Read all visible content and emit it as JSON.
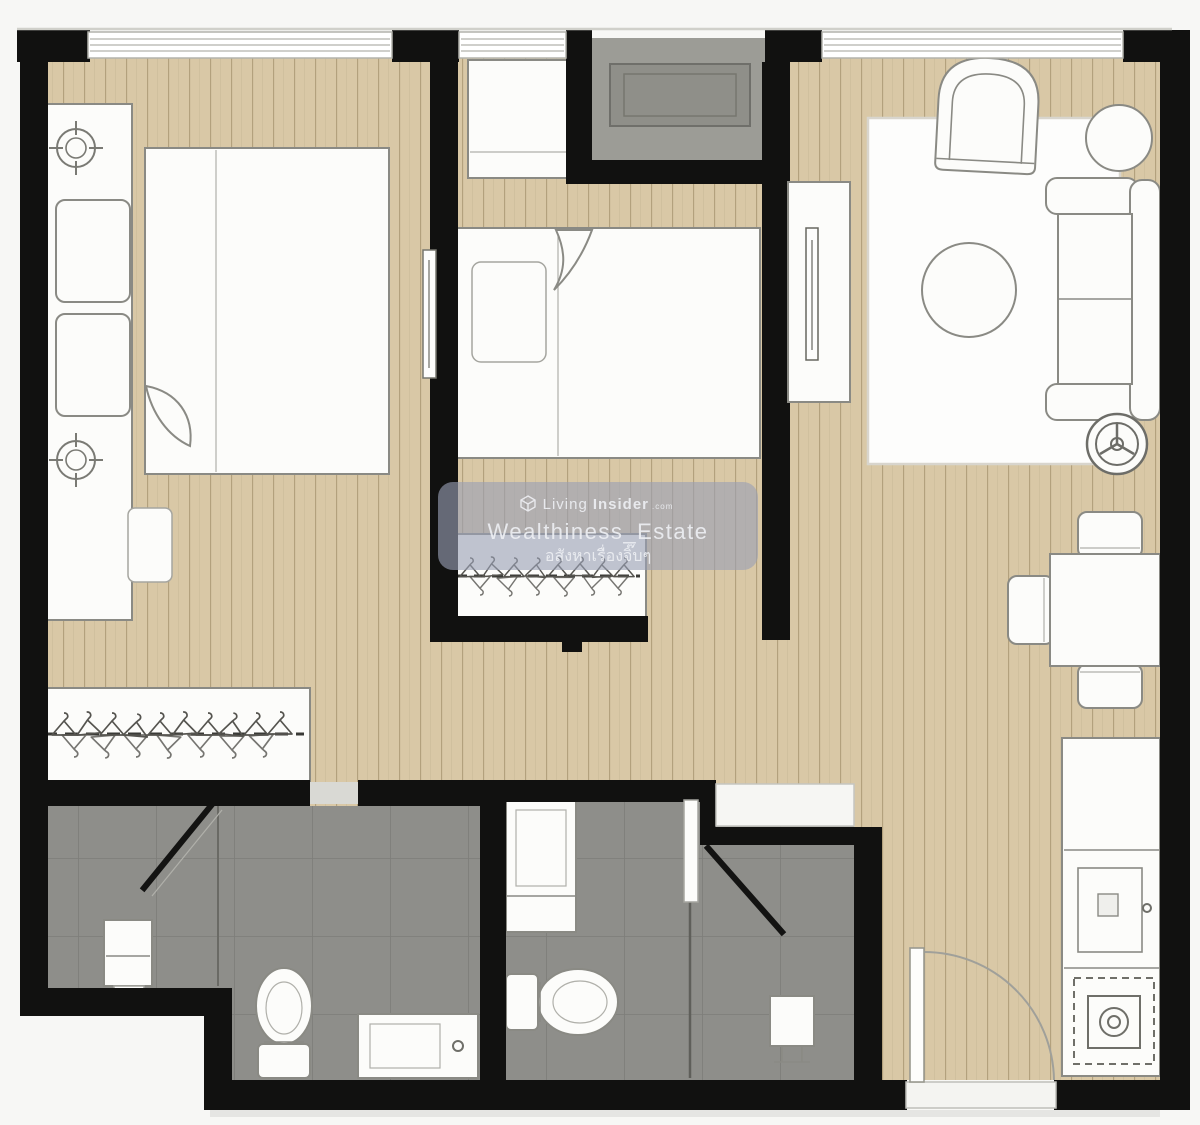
{
  "watermark": {
    "logo_icon": "living-insider-cube-icon",
    "brand_prefix": "Living",
    "brand_suffix": "Insider",
    "brand_tld": ".com",
    "account_name": "Wealthiness_Estate",
    "tagline_thai": "อสังหาเรื่องจิ๊บๆ",
    "background_color": "#9aa0b5",
    "text_color": "#eef0f4"
  },
  "floor_plan": {
    "description": "two-bedroom condominium unit floor plan, top-down view, no text labels",
    "colors": {
      "wall": "#111110",
      "wood_floor": "#d9c8a6",
      "wood_plank_line": "#b3a17d",
      "bathroom_tile": "#8e8e8a",
      "tile_grout": "#7e7e7a",
      "ledge_gray": "#9c9c96",
      "furniture_fill": "#fcfcfa",
      "furniture_outline": "#8a8a84",
      "background": "#f7f7f5"
    },
    "rooms": [
      {
        "name": "bedroom-1",
        "furniture": [
          "double-bed",
          "pillows",
          "bedside-console",
          "ceiling-light-symbol",
          "ceiling-light-symbol",
          "desk-chair",
          "wardrobe-with-hangers",
          "wall-tv"
        ]
      },
      {
        "name": "bedroom-2",
        "furniture": [
          "single-bed",
          "pillow",
          "window-desk",
          "wardrobe-with-hangers"
        ]
      },
      {
        "name": "living-room",
        "furniture": [
          "rug",
          "armchair",
          "round-side-table",
          "round-coffee-table",
          "sofa",
          "tv-console",
          "electric-fan"
        ]
      },
      {
        "name": "dining-area",
        "furniture": [
          "dining-table",
          "dining-chair",
          "dining-chair",
          "dining-chair"
        ]
      },
      {
        "name": "kitchen",
        "furniture": [
          "counter",
          "sink",
          "stove"
        ]
      },
      {
        "name": "bathroom-1",
        "furniture": [
          "shower-glass-door",
          "shower-stool",
          "toilet",
          "vanity-sink"
        ]
      },
      {
        "name": "bathroom-2",
        "furniture": [
          "vanity-sink",
          "toilet",
          "partition",
          "shower-glass-door",
          "shower-stand",
          "bathroom-door"
        ]
      },
      {
        "name": "ac-ledge",
        "furniture": [
          "ac-compressor-unit"
        ]
      },
      {
        "name": "entrance",
        "furniture": [
          "entrance-door-leaf",
          "door-swing-arc",
          "threshold"
        ]
      }
    ],
    "windows": 3
  }
}
